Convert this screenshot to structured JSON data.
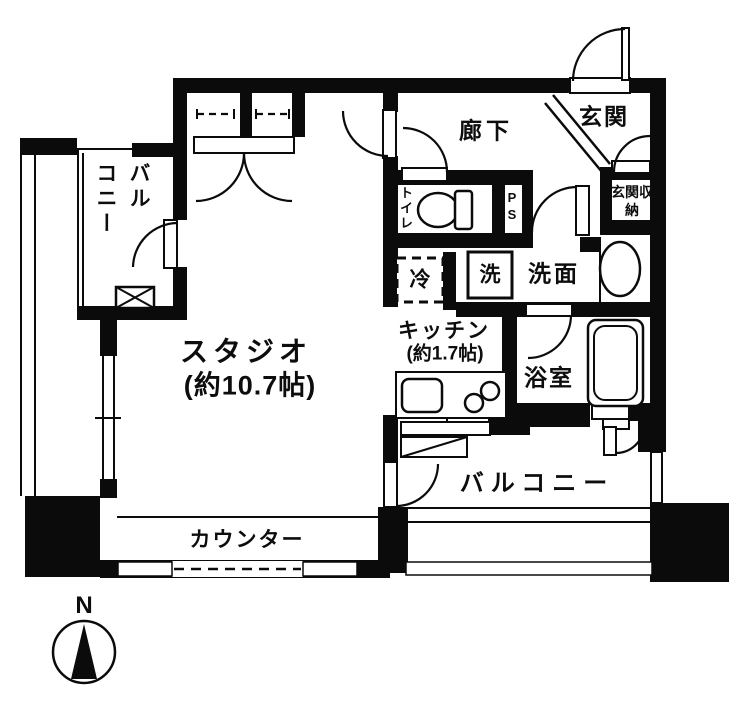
{
  "floor_plan": {
    "compass_north": "N",
    "rooms": {
      "studio": {
        "name": "スタジオ",
        "size": "(約10.7帖)"
      },
      "kitchen": {
        "name": "キッチン",
        "size": "(約1.7帖)"
      },
      "hallway": {
        "name": "廊下"
      },
      "entrance": {
        "name": "玄関"
      },
      "entrance_storage": {
        "name": "玄関収納"
      },
      "toilet": {
        "name": "トイレ"
      },
      "pipe_space": {
        "name": "PS"
      },
      "washroom": {
        "name": "洗面"
      },
      "washer": {
        "name": "洗"
      },
      "refrigerator": {
        "name": "冷"
      },
      "bathroom": {
        "name": "浴室"
      },
      "counter": {
        "name": "カウンター"
      },
      "balcony_upper": {
        "column1": "バル",
        "column2": "コニー"
      },
      "balcony_lower": {
        "name": "バルコニー"
      }
    },
    "colors": {
      "wall": "#0b0b0b",
      "background": "#ffffff"
    }
  }
}
